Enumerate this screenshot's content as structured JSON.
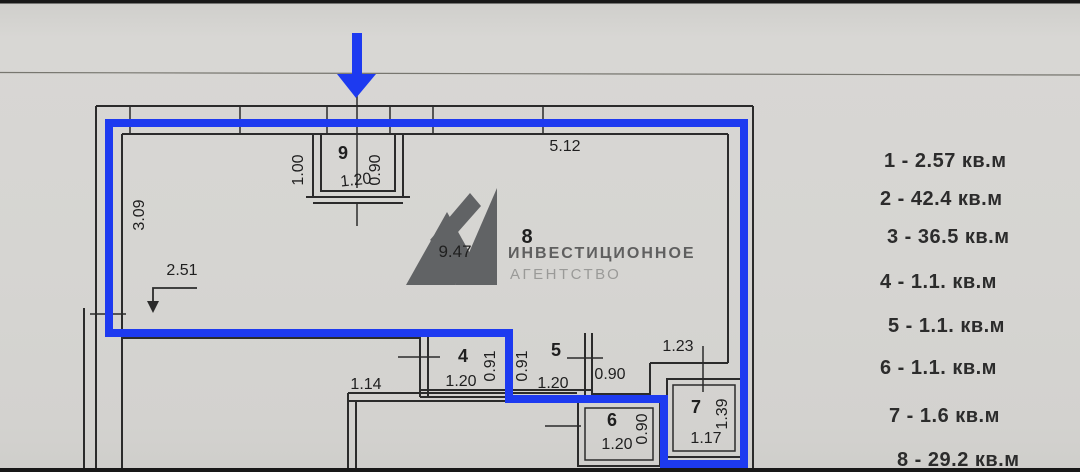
{
  "legend": {
    "items": [
      {
        "label": "1 - 2.57 кв.м"
      },
      {
        "label": "2 - 42.4 кв.м"
      },
      {
        "label": "3 - 36.5 кв.м"
      },
      {
        "label": "4 - 1.1. кв.м"
      },
      {
        "label": "5 - 1.1. кв.м"
      },
      {
        "label": "6 - 1.1. кв.м"
      },
      {
        "label": "7 - 1.6 кв.м"
      },
      {
        "label": "8 - 29.2 кв.м"
      }
    ]
  },
  "watermark": {
    "brand_line1": "ИНВЕСТИЦИОННОЕ",
    "brand_line2": "АГЕНТСТВО"
  },
  "plan": {
    "rooms": {
      "r9": {
        "number": "9",
        "width": "1.20",
        "side_right": "0.90",
        "side_left": "1.00"
      },
      "r8": {
        "number": "8",
        "diag": "9.47"
      },
      "r4": {
        "number": "4",
        "width": "1.20",
        "depth": "0.91"
      },
      "r5": {
        "number": "5",
        "width": "1.20",
        "depth": "0.91"
      },
      "r6": {
        "number": "6",
        "width": "1.20",
        "depth": "0.90"
      },
      "r7": {
        "number": "7",
        "width": "1.17",
        "depth": "1.39"
      }
    },
    "dims": {
      "top_wall": "5.12",
      "left_wall": "3.09",
      "left_inner": "2.51",
      "bottom_left": "1.14",
      "corridor": "0.90",
      "step": "1.23"
    }
  },
  "colors": {
    "highlight_blue": "#1d3af0",
    "plan_line": "#2b2b2b",
    "paper": "#d6d5d2",
    "watermark_gray": "#55575a"
  }
}
